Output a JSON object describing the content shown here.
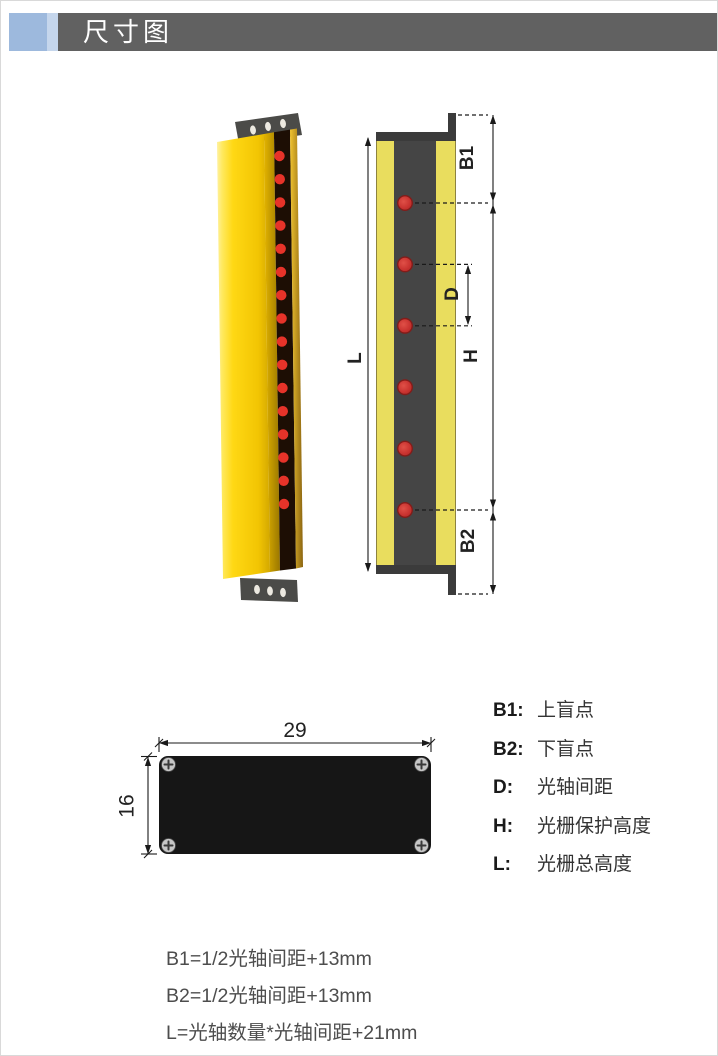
{
  "header": {
    "title": "尺寸图"
  },
  "colors": {
    "header_bar": "#616161",
    "header_accent": "#9db9dd",
    "body_yellow": "#ffd814",
    "section_yellow": "#e9dd5e",
    "section_dark": "#454545",
    "led_red": "#e73329",
    "beam_red": "#c93330",
    "line_black": "#1a1a1a"
  },
  "diagram_3d": {
    "description": "light-curtain-product",
    "led_count": 16
  },
  "diagram_2d": {
    "beam_count": 6,
    "labels": {
      "l": "L",
      "b1": "B1",
      "d": "D",
      "h": "H",
      "b2": "B2"
    }
  },
  "bottom_view": {
    "width_label": "29",
    "height_label": "16"
  },
  "legend": {
    "items": [
      {
        "key": "B1:",
        "desc": "上盲点"
      },
      {
        "key": "B2:",
        "desc": "下盲点"
      },
      {
        "key": "D:",
        "desc": "光轴间距"
      },
      {
        "key": "H:",
        "desc": "光栅保护高度"
      },
      {
        "key": "L:",
        "desc": "光栅总高度"
      }
    ]
  },
  "formulas": [
    "B1=1/2光轴间距+13mm",
    "B2=1/2光轴间距+13mm",
    "L=光轴数量*光轴间距+21mm"
  ]
}
